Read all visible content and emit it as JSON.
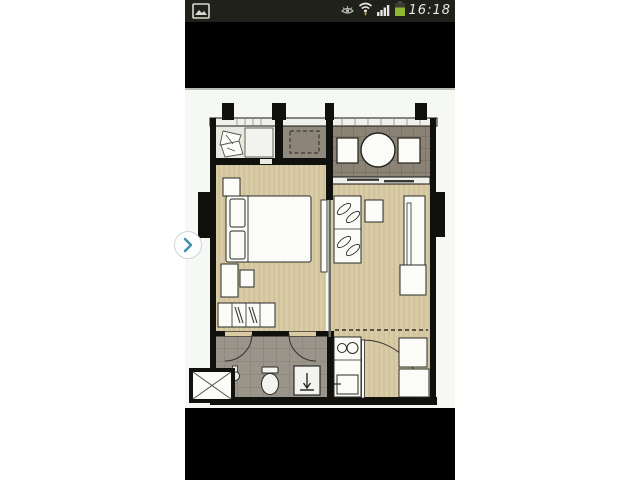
{
  "status_bar": {
    "time": "16:18",
    "background": "#21211b",
    "battery_color": "#8fb832",
    "icon_color": "#d9d9cf",
    "icons": [
      "screenshot-thumbnail",
      "smart-stay-eye",
      "wifi",
      "signal-strength",
      "battery",
      "clock-text"
    ]
  },
  "viewer": {
    "nav_next_chevron_color": "#3e8fb0",
    "photo_background": "#f5f8f3",
    "screen_background": "#000000"
  },
  "floor_plan": {
    "subject": "one-bedroom-condo-unit",
    "rooms": [
      "balcony",
      "ac-ledge",
      "terrace-dining",
      "bedroom",
      "living-room",
      "bathroom",
      "kitchen",
      "entrance-hall",
      "service-shaft"
    ],
    "palette": {
      "wall_black": "#10100c",
      "wood_floor": "#d8cba5",
      "wood_floor_stripe": "#c9bb93",
      "terrace_gray": "#8b8375",
      "terrace_grid": "#6e6759",
      "bathroom_gray": "#9a948a",
      "bathroom_grid": "#857e73",
      "ac_ledge_gray": "#90897d",
      "balcony_light": "#e8eae1",
      "furniture_white": "#fbfbf7",
      "outline_dark": "#2a2a26"
    }
  }
}
